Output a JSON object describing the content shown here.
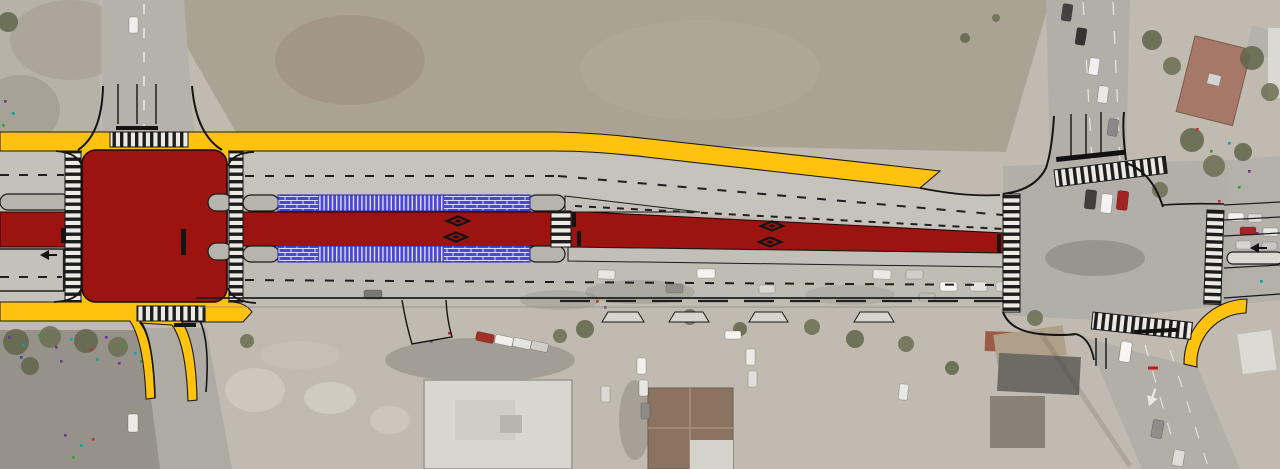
{
  "scene": {
    "kind": "roadway-transit-corridor-design-plan-over-aerial-photo",
    "orientation": "corridor-runs-horizontal-with-cross-streets-at-left-and-right"
  },
  "colors": {
    "transit_red": "#9C1310",
    "curb_yellow": "#FFC20E",
    "platform_blue": "#4B48D4",
    "road_gray": "#C6C3BC",
    "road_gray_lower": "#BFBCB4",
    "median_gray": "#B7B4AD",
    "asphalt": "#B2AFA9",
    "field": "#AAA393",
    "lot_gray": "#96928A",
    "aerial_base": "#C1BAB0"
  },
  "markings": {
    "diamonds": [
      [
        458,
        221
      ],
      [
        456,
        237
      ],
      [
        772,
        226
      ],
      [
        770,
        242
      ]
    ],
    "arrows": [
      {
        "x": 48,
        "y": 255,
        "rot": 0,
        "scale": 1,
        "fill": "#141414"
      },
      {
        "x": 1258,
        "y": 248,
        "rot": 0,
        "scale": 1,
        "fill": "#141414"
      },
      {
        "x": 1152,
        "y": 398,
        "rot": -70,
        "scale": 1.1,
        "fill": "#e9e8e3"
      }
    ],
    "stop_bars": [
      {
        "x": 61,
        "y": 228,
        "w": 5,
        "h": 15
      },
      {
        "x": 181,
        "y": 229,
        "w": 5,
        "h": 26
      },
      {
        "x": 572,
        "y": 212,
        "w": 4,
        "h": 15
      },
      {
        "x": 577,
        "y": 231,
        "w": 4,
        "h": 15
      },
      {
        "x": 997,
        "y": 234,
        "w": 4,
        "h": 19
      },
      {
        "x": 116,
        "y": 126,
        "w": 42,
        "h": 4
      },
      {
        "x": 174,
        "y": 323,
        "w": 22,
        "h": 4
      }
    ],
    "median_pills": [
      {
        "x": 0,
        "y": 194,
        "w": 70,
        "h": 16
      },
      {
        "x": 208,
        "y": 194,
        "w": 24,
        "h": 17
      },
      {
        "x": 208,
        "y": 243,
        "w": 24,
        "h": 17
      },
      {
        "x": 243,
        "y": 195,
        "w": 36,
        "h": 16
      },
      {
        "x": 243,
        "y": 246,
        "w": 36,
        "h": 16
      },
      {
        "x": 528,
        "y": 195,
        "w": 37,
        "h": 16
      },
      {
        "x": 528,
        "y": 246,
        "w": 37,
        "h": 16
      }
    ],
    "crosswalks": [
      {
        "x": 65,
        "y": 152,
        "w": 16,
        "h": 150,
        "dir": "H",
        "rot": 0
      },
      {
        "x": 229,
        "y": 152,
        "w": 14,
        "h": 150,
        "dir": "H",
        "rot": 0
      },
      {
        "x": 110,
        "y": 132,
        "w": 78,
        "h": 15,
        "dir": "V",
        "rot": 0
      },
      {
        "x": 137,
        "y": 306,
        "w": 68,
        "h": 15,
        "dir": "V",
        "rot": 0
      },
      {
        "x": 551,
        "y": 211,
        "w": 20,
        "h": 36,
        "dir": "H",
        "rot": 0
      },
      {
        "x": 1003,
        "y": 194,
        "w": 17,
        "h": 118,
        "dir": "H",
        "rot": 0
      },
      {
        "x": 1054,
        "y": 170,
        "w": 112,
        "h": 17,
        "dir": "V",
        "rot": -7
      },
      {
        "x": 1207,
        "y": 210,
        "w": 17,
        "h": 94,
        "dir": "H",
        "rot": 2
      },
      {
        "x": 1093,
        "y": 312,
        "w": 100,
        "h": 17,
        "dir": "V",
        "rot": 6
      }
    ],
    "driveway_aprons": [
      {
        "x": 608,
        "y": 312,
        "w": 30
      },
      {
        "x": 675,
        "y": 312,
        "w": 28
      },
      {
        "x": 755,
        "y": 312,
        "w": 27
      },
      {
        "x": 860,
        "y": 312,
        "w": 28
      }
    ]
  },
  "aerial": {
    "cars": [
      [
        598,
        270,
        17,
        9,
        2,
        "#e8e6e1"
      ],
      [
        666,
        284,
        17,
        9,
        0,
        "#908e89"
      ],
      [
        697,
        269,
        18,
        9,
        0,
        "#f3f2ef"
      ],
      [
        759,
        285,
        16,
        8,
        0,
        "#d9d7d2"
      ],
      [
        873,
        270,
        18,
        9,
        2,
        "#eae9e5"
      ],
      [
        906,
        270,
        17,
        9,
        0,
        "#d0cec9"
      ],
      [
        940,
        282,
        17,
        9,
        0,
        "#f5f4f1"
      ],
      [
        970,
        282,
        17,
        9,
        0,
        "#e3e2de"
      ],
      [
        996,
        282,
        16,
        9,
        0,
        "#d9d8d4"
      ],
      [
        919,
        293,
        16,
        8,
        0,
        "#bebcb7"
      ],
      [
        364,
        290,
        18,
        9,
        0,
        "#7a7872"
      ],
      [
        1062,
        4,
        10,
        17,
        8,
        "#454341"
      ],
      [
        1076,
        28,
        10,
        17,
        8,
        "#34332f"
      ],
      [
        1089,
        58,
        10,
        17,
        8,
        "#f1f0ee"
      ],
      [
        1098,
        86,
        10,
        17,
        8,
        "#eae9e6"
      ],
      [
        1108,
        119,
        10,
        17,
        8,
        "#8b8987"
      ],
      [
        1085,
        190,
        11,
        19,
        6,
        "#413f3d"
      ],
      [
        1101,
        194,
        11,
        19,
        6,
        "#f4f3f1"
      ],
      [
        1117,
        191,
        11,
        19,
        6,
        "#a32222"
      ],
      [
        1228,
        213,
        16,
        8,
        0,
        "#f2f1ee"
      ],
      [
        1248,
        214,
        14,
        8,
        0,
        "#dedcd8"
      ],
      [
        1240,
        227,
        16,
        8,
        0,
        "#a52525"
      ],
      [
        1263,
        228,
        15,
        8,
        0,
        "#e9e8e5"
      ],
      [
        1236,
        241,
        15,
        8,
        0,
        "#d6d4d0"
      ],
      [
        1262,
        242,
        15,
        8,
        0,
        "#c9c7c3"
      ],
      [
        1120,
        341,
        11,
        20,
        8,
        "#f6f5f2"
      ],
      [
        1152,
        420,
        11,
        18,
        10,
        "#8f8d8a"
      ],
      [
        1173,
        450,
        11,
        16,
        10,
        "#deddda"
      ],
      [
        476,
        333,
        18,
        9,
        12,
        "#a33026"
      ],
      [
        495,
        336,
        18,
        9,
        12,
        "#f1efec"
      ],
      [
        513,
        339,
        18,
        9,
        12,
        "#e5e3df"
      ],
      [
        531,
        342,
        17,
        9,
        12,
        "#d0cec9"
      ],
      [
        637,
        358,
        9,
        16,
        0,
        "#f2f1ed"
      ],
      [
        639,
        380,
        9,
        16,
        0,
        "#e7e6e2"
      ],
      [
        641,
        403,
        9,
        16,
        0,
        "#8d8b87"
      ],
      [
        601,
        386,
        9,
        16,
        0,
        "#dbd9d5"
      ],
      [
        725,
        331,
        16,
        8,
        0,
        "#f4f3ef"
      ],
      [
        746,
        349,
        9,
        16,
        0,
        "#edebe7"
      ],
      [
        748,
        371,
        9,
        16,
        0,
        "#e1dfdb"
      ],
      [
        899,
        384,
        9,
        16,
        5,
        "#e9e8e4"
      ],
      [
        128,
        414,
        10,
        18,
        0,
        "#eceae6"
      ],
      [
        129,
        17,
        9,
        16,
        0,
        "#f0efec"
      ],
      [
        1120,
        342,
        11,
        20,
        8,
        "#f6f5f2"
      ]
    ],
    "trees": [
      [
        16,
        342,
        13
      ],
      [
        50,
        337,
        11
      ],
      [
        86,
        341,
        12
      ],
      [
        118,
        347,
        10
      ],
      [
        30,
        366,
        9
      ],
      [
        247,
        341,
        7
      ],
      [
        1152,
        40,
        10
      ],
      [
        1172,
        66,
        9
      ],
      [
        1192,
        140,
        12
      ],
      [
        1214,
        166,
        11
      ],
      [
        1243,
        152,
        9
      ],
      [
        1160,
        190,
        8
      ],
      [
        1252,
        58,
        12
      ],
      [
        1270,
        92,
        9
      ],
      [
        585,
        329,
        9
      ],
      [
        690,
        317,
        8
      ],
      [
        740,
        329,
        7
      ],
      [
        812,
        327,
        8
      ],
      [
        855,
        339,
        9
      ],
      [
        906,
        344,
        8
      ],
      [
        952,
        368,
        7
      ],
      [
        1035,
        318,
        8
      ],
      [
        8,
        22,
        10
      ],
      [
        560,
        336,
        7
      ],
      [
        965,
        38,
        5
      ],
      [
        996,
        18,
        4
      ]
    ],
    "speckles": [
      [
        8,
        336,
        0
      ],
      [
        22,
        344,
        1
      ],
      [
        38,
        334,
        2
      ],
      [
        55,
        346,
        0
      ],
      [
        70,
        338,
        1
      ],
      [
        90,
        348,
        3
      ],
      [
        105,
        336,
        0
      ],
      [
        122,
        344,
        2
      ],
      [
        134,
        352,
        1
      ],
      [
        20,
        356,
        4
      ],
      [
        60,
        360,
        0
      ],
      [
        96,
        358,
        1
      ],
      [
        118,
        362,
        0
      ],
      [
        140,
        360,
        2
      ],
      [
        64,
        434,
        0
      ],
      [
        80,
        444,
        1
      ],
      [
        72,
        456,
        2
      ],
      [
        92,
        438,
        3
      ],
      [
        1196,
        128,
        3
      ],
      [
        1210,
        150,
        2
      ],
      [
        1228,
        142,
        1
      ],
      [
        1248,
        170,
        0
      ],
      [
        1238,
        186,
        2
      ],
      [
        1218,
        200,
        3
      ],
      [
        1256,
        232,
        0
      ],
      [
        1242,
        258,
        2
      ],
      [
        1260,
        280,
        1
      ],
      [
        200,
        308,
        0
      ],
      [
        208,
        314,
        2
      ],
      [
        596,
        300,
        3
      ],
      [
        604,
        306,
        0
      ],
      [
        4,
        100,
        0
      ],
      [
        12,
        112,
        1
      ],
      [
        2,
        124,
        2
      ],
      [
        448,
        332,
        3
      ],
      [
        430,
        340,
        0
      ]
    ],
    "speckle_palette": [
      "#7030a0",
      "#00a8a8",
      "#2f9e33",
      "#c03030",
      "#2f3fc0"
    ]
  }
}
